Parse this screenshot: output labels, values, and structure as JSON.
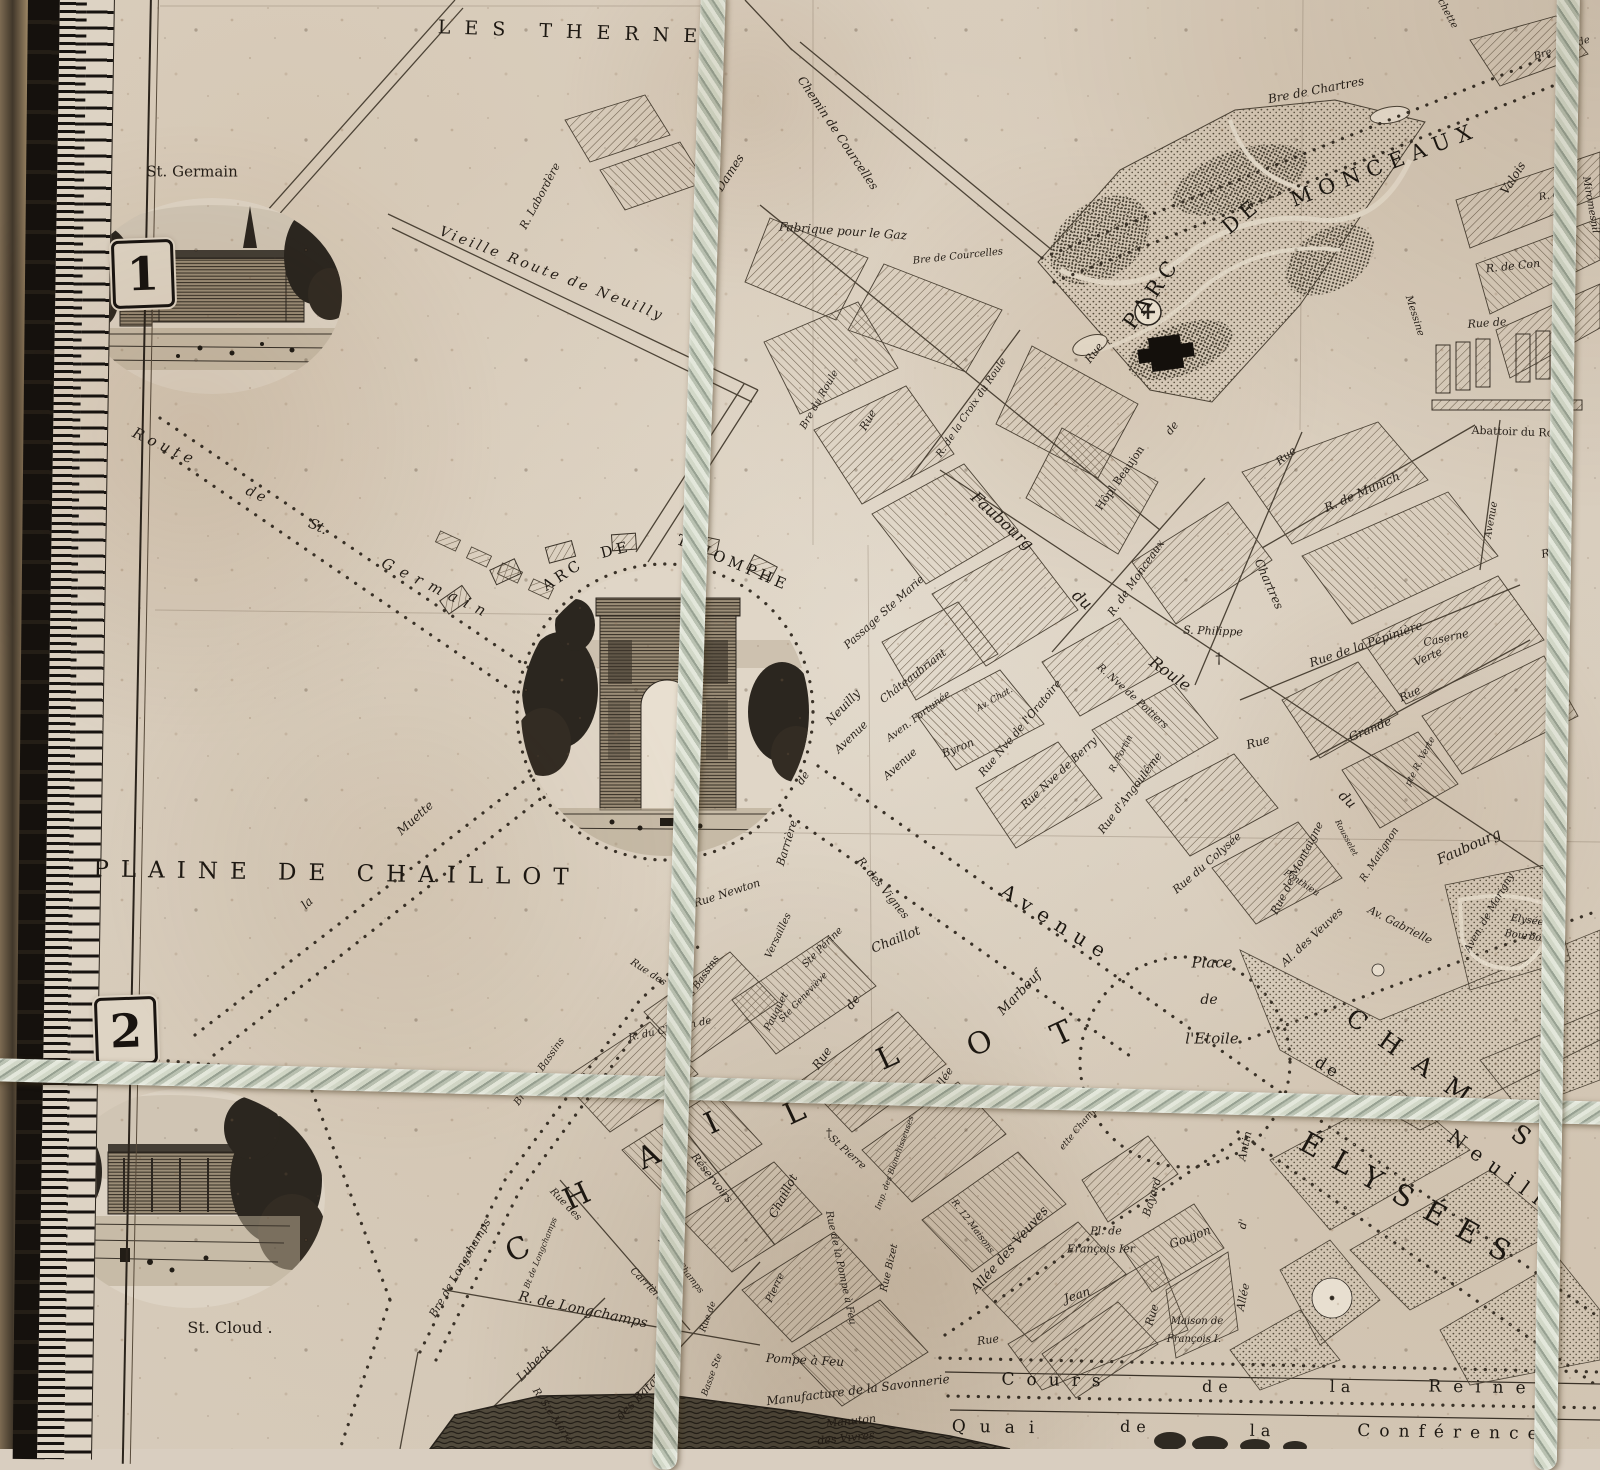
{
  "plates": {
    "n1": "1",
    "n2": "2"
  },
  "colors": {
    "paper": "#dcd2c3",
    "ink": "#27211a",
    "rope": "#b9c1b1",
    "hatch": "#6a5c4b"
  },
  "labels": [
    {
      "t": "LES THERNES",
      "x": 588,
      "y": 33,
      "r": 2,
      "s": 19,
      "ls": 14,
      "c": "cap"
    },
    {
      "t": "St. Germain",
      "x": 192,
      "y": 172,
      "r": 0,
      "s": 15,
      "c": "rm"
    },
    {
      "t": "Chemin de Courcelles",
      "x": 838,
      "y": 133,
      "r": 56,
      "s": 12
    },
    {
      "t": "des Dames",
      "x": 723,
      "y": 183,
      "r": -57,
      "s": 12
    },
    {
      "t": "R. Labordère",
      "x": 540,
      "y": 196,
      "r": -62,
      "s": 11
    },
    {
      "t": "Vieille Route de Neuilly",
      "x": 552,
      "y": 274,
      "r": 21,
      "s": 14,
      "ls": 3
    },
    {
      "t": "Fabrique pour le Gaz",
      "x": 843,
      "y": 231,
      "r": 4,
      "s": 12
    },
    {
      "t": "Bre de Courcelles",
      "x": 958,
      "y": 257,
      "r": -6,
      "s": 10
    },
    {
      "t": "Bre de Chartres",
      "x": 1316,
      "y": 90,
      "r": -11,
      "s": 12
    },
    {
      "t": "chette",
      "x": 1447,
      "y": 14,
      "r": 62,
      "s": 10
    },
    {
      "t": "Bre",
      "x": 1543,
      "y": 55,
      "r": -18,
      "s": 10
    },
    {
      "t": "de",
      "x": 1584,
      "y": 42,
      "r": -18,
      "s": 10
    },
    {
      "t": "PARC",
      "x": 1152,
      "y": 293,
      "r": -55,
      "s": 21,
      "ls": 6,
      "c": "cap"
    },
    {
      "t": "DE",
      "x": 1242,
      "y": 216,
      "r": -40,
      "s": 21,
      "ls": 6,
      "c": "cap"
    },
    {
      "t": "MONCEAUX",
      "x": 1385,
      "y": 165,
      "r": -21,
      "s": 21,
      "ls": 8,
      "c": "cap"
    },
    {
      "t": "Valois",
      "x": 1513,
      "y": 178,
      "r": -58,
      "s": 12
    },
    {
      "t": "R. de",
      "x": 1552,
      "y": 196,
      "r": -10,
      "s": 10
    },
    {
      "t": "R. de Con",
      "x": 1513,
      "y": 266,
      "r": -6,
      "s": 11
    },
    {
      "t": "Rue de",
      "x": 1487,
      "y": 323,
      "r": -4,
      "s": 11
    },
    {
      "t": "Messine",
      "x": 1414,
      "y": 316,
      "r": 72,
      "s": 10
    },
    {
      "t": "Miromesnil",
      "x": 1590,
      "y": 205,
      "r": 80,
      "s": 10
    },
    {
      "t": "Abattoir du Roule",
      "x": 1521,
      "y": 432,
      "r": 2,
      "s": 11,
      "c": "rm"
    },
    {
      "t": "Rue",
      "x": 1094,
      "y": 353,
      "r": -52,
      "s": 11
    },
    {
      "t": "de",
      "x": 1172,
      "y": 428,
      "r": -52,
      "s": 11
    },
    {
      "t": "Rue",
      "x": 1286,
      "y": 456,
      "r": -38,
      "s": 11
    },
    {
      "t": "Chartres",
      "x": 1269,
      "y": 584,
      "r": 66,
      "s": 12
    },
    {
      "t": "R. de Munich",
      "x": 1362,
      "y": 492,
      "r": -24,
      "s": 12
    },
    {
      "t": "Avenue",
      "x": 1492,
      "y": 520,
      "r": -80,
      "s": 10
    },
    {
      "t": "Rue",
      "x": 1552,
      "y": 552,
      "r": -14,
      "s": 11
    },
    {
      "t": "Hôpl Beaujon",
      "x": 1120,
      "y": 478,
      "r": -55,
      "s": 11,
      "c": "rm"
    },
    {
      "t": "R. de la Croix du Roule",
      "x": 972,
      "y": 408,
      "r": -56,
      "s": 10
    },
    {
      "t": "Bre du Roule",
      "x": 820,
      "y": 400,
      "r": -60,
      "s": 10
    },
    {
      "t": "Rue",
      "x": 868,
      "y": 420,
      "r": -60,
      "s": 11
    },
    {
      "t": "Faubourg",
      "x": 1002,
      "y": 521,
      "r": 42,
      "s": 16
    },
    {
      "t": "du",
      "x": 1082,
      "y": 600,
      "r": 42,
      "s": 16
    },
    {
      "t": "Roule",
      "x": 1170,
      "y": 674,
      "r": 36,
      "s": 16
    },
    {
      "t": "Passage Ste Marie",
      "x": 884,
      "y": 612,
      "r": -42,
      "s": 11
    },
    {
      "t": "S. Philippe",
      "x": 1213,
      "y": 631,
      "r": 2,
      "s": 11
    },
    {
      "t": "†",
      "x": 1219,
      "y": 659,
      "r": 0,
      "s": 15,
      "c": "rm"
    },
    {
      "t": "R. de Monceaux",
      "x": 1136,
      "y": 578,
      "r": -55,
      "s": 11
    },
    {
      "t": "Rue de la Pépinière",
      "x": 1366,
      "y": 644,
      "r": -19,
      "s": 12
    },
    {
      "t": "Caserne",
      "x": 1446,
      "y": 638,
      "r": -12,
      "s": 11
    },
    {
      "t": "Rue",
      "x": 1410,
      "y": 694,
      "r": -24,
      "s": 11
    },
    {
      "t": "Verte",
      "x": 1428,
      "y": 657,
      "r": -24,
      "s": 11
    },
    {
      "t": "Grande",
      "x": 1370,
      "y": 729,
      "r": -23,
      "s": 12
    },
    {
      "t": "Rue",
      "x": 1258,
      "y": 742,
      "r": -16,
      "s": 12
    },
    {
      "t": "pte R. Verte",
      "x": 1421,
      "y": 762,
      "r": -62,
      "s": 9
    },
    {
      "t": "du",
      "x": 1347,
      "y": 800,
      "r": 44,
      "s": 14
    },
    {
      "t": "Faubourg",
      "x": 1469,
      "y": 847,
      "r": -24,
      "s": 14
    },
    {
      "t": "Avenue",
      "x": 851,
      "y": 737,
      "r": -44,
      "s": 11
    },
    {
      "t": "Châteaubriant",
      "x": 913,
      "y": 676,
      "r": -38,
      "s": 11
    },
    {
      "t": "Aven. Fortunée",
      "x": 919,
      "y": 717,
      "r": -37,
      "s": 10
    },
    {
      "t": "Avenue",
      "x": 900,
      "y": 764,
      "r": -42,
      "s": 11
    },
    {
      "t": "Byron",
      "x": 958,
      "y": 748,
      "r": -22,
      "s": 11
    },
    {
      "t": "Av. Chat.",
      "x": 995,
      "y": 700,
      "r": -30,
      "s": 9
    },
    {
      "t": "Rue Nve de l'Oratoire",
      "x": 1020,
      "y": 728,
      "r": -50,
      "s": 11
    },
    {
      "t": "R. Nve de Poitiers",
      "x": 1132,
      "y": 697,
      "r": 42,
      "s": 10
    },
    {
      "t": "Rue Nve de Berry",
      "x": 1059,
      "y": 773,
      "r": -43,
      "s": 11
    },
    {
      "t": "R. Fortin",
      "x": 1122,
      "y": 754,
      "r": -62,
      "s": 9
    },
    {
      "t": "Rue d'Angoulême",
      "x": 1130,
      "y": 793,
      "r": -53,
      "s": 11
    },
    {
      "t": "Rue du Colysée",
      "x": 1207,
      "y": 863,
      "r": -41,
      "s": 11
    },
    {
      "t": "Rue de Montaigne",
      "x": 1297,
      "y": 868,
      "r": -63,
      "s": 11
    },
    {
      "t": "Ponthieu",
      "x": 1301,
      "y": 884,
      "r": 33,
      "s": 9
    },
    {
      "t": "Rousselet",
      "x": 1346,
      "y": 838,
      "r": 62,
      "s": 8
    },
    {
      "t": "R. Matignon",
      "x": 1380,
      "y": 855,
      "r": -57,
      "s": 10
    },
    {
      "t": "Al. des Veuves",
      "x": 1312,
      "y": 937,
      "r": -43,
      "s": 11
    },
    {
      "t": "Av. Gabrielle",
      "x": 1400,
      "y": 925,
      "r": 27,
      "s": 11
    },
    {
      "t": "Aven. de Marigny",
      "x": 1490,
      "y": 913,
      "r": -60,
      "s": 10
    },
    {
      "t": "Elysée",
      "x": 1527,
      "y": 921,
      "r": 8,
      "s": 10
    },
    {
      "t": "Bourbon",
      "x": 1526,
      "y": 937,
      "r": 8,
      "s": 10
    },
    {
      "t": "Place",
      "x": 1212,
      "y": 963,
      "r": 0,
      "s": 15
    },
    {
      "t": "de",
      "x": 1209,
      "y": 1000,
      "r": 0,
      "s": 14
    },
    {
      "t": "l'Etoile",
      "x": 1212,
      "y": 1039,
      "r": 0,
      "s": 15
    },
    {
      "t": "Avenue",
      "x": 1057,
      "y": 923,
      "r": 32,
      "s": 20,
      "ls": 9,
      "c": "cap"
    },
    {
      "t": "de",
      "x": 1328,
      "y": 1068,
      "r": 32,
      "s": 16,
      "ls": 4,
      "c": "cap"
    },
    {
      "t": "Neuilly",
      "x": 1508,
      "y": 1176,
      "r": 36,
      "s": 20,
      "ls": 10,
      "c": "cap"
    },
    {
      "t": "CHAMPS",
      "x": 1447,
      "y": 1083,
      "r": 35,
      "s": 25,
      "ls": 20,
      "c": "cap"
    },
    {
      "t": "ÉLYSÉES",
      "x": 1412,
      "y": 1201,
      "r": 29,
      "s": 29,
      "ls": 16,
      "c": "cap"
    },
    {
      "t": "C",
      "x": 518,
      "y": 1250,
      "r": -25,
      "s": 30,
      "c": "cap"
    },
    {
      "t": "H",
      "x": 577,
      "y": 1197,
      "r": -25,
      "s": 30,
      "c": "cap"
    },
    {
      "t": "A",
      "x": 649,
      "y": 1157,
      "r": -25,
      "s": 30,
      "c": "cap"
    },
    {
      "t": "I",
      "x": 712,
      "y": 1124,
      "r": -25,
      "s": 30,
      "c": "cap"
    },
    {
      "t": "L",
      "x": 795,
      "y": 1113,
      "r": -25,
      "s": 30,
      "c": "cap"
    },
    {
      "t": "L",
      "x": 888,
      "y": 1058,
      "r": -25,
      "s": 30,
      "c": "cap"
    },
    {
      "t": "O",
      "x": 980,
      "y": 1044,
      "r": -25,
      "s": 30,
      "c": "cap"
    },
    {
      "t": "T",
      "x": 1062,
      "y": 1034,
      "r": -25,
      "s": 30,
      "c": "cap"
    },
    {
      "t": "Barrière",
      "x": 787,
      "y": 843,
      "r": -73,
      "s": 11
    },
    {
      "t": "de",
      "x": 803,
      "y": 778,
      "r": -55,
      "s": 11
    },
    {
      "t": "Neuilly",
      "x": 843,
      "y": 707,
      "r": -46,
      "s": 12
    },
    {
      "t": "Rue Newton",
      "x": 727,
      "y": 893,
      "r": -18,
      "s": 11
    },
    {
      "t": "R. des Bassins",
      "x": 697,
      "y": 987,
      "r": -55,
      "s": 10
    },
    {
      "t": "Bre des Bassins",
      "x": 540,
      "y": 1072,
      "r": -55,
      "s": 10
    },
    {
      "t": "R. du Chemin de",
      "x": 670,
      "y": 1030,
      "r": -12,
      "s": 10
    },
    {
      "t": "Versailles",
      "x": 779,
      "y": 936,
      "r": -65,
      "s": 10
    },
    {
      "t": "Pauquet",
      "x": 777,
      "y": 1012,
      "r": -63,
      "s": 10
    },
    {
      "t": "Ste Périne",
      "x": 823,
      "y": 948,
      "r": -45,
      "s": 10
    },
    {
      "t": "Ste Geneviève",
      "x": 804,
      "y": 998,
      "r": -46,
      "s": 9
    },
    {
      "t": "R. des Vignes",
      "x": 883,
      "y": 888,
      "r": 51,
      "s": 11
    },
    {
      "t": "Rue",
      "x": 822,
      "y": 1058,
      "r": -55,
      "s": 12
    },
    {
      "t": "de",
      "x": 853,
      "y": 1002,
      "r": -50,
      "s": 12
    },
    {
      "t": "Chaillot",
      "x": 896,
      "y": 940,
      "r": -22,
      "s": 13
    },
    {
      "t": "Marbeuf",
      "x": 1020,
      "y": 993,
      "r": -46,
      "s": 13
    },
    {
      "t": "Allée",
      "x": 943,
      "y": 1080,
      "r": -57,
      "s": 11
    },
    {
      "t": "Rue des",
      "x": 648,
      "y": 973,
      "r": 33,
      "s": 10
    },
    {
      "t": "Réservoirs",
      "x": 712,
      "y": 1178,
      "r": 52,
      "s": 11
    },
    {
      "t": "Rue des",
      "x": 565,
      "y": 1205,
      "r": 46,
      "s": 10
    },
    {
      "t": "Carrières",
      "x": 648,
      "y": 1287,
      "r": 46,
      "s": 10
    },
    {
      "t": "R. des Champs",
      "x": 680,
      "y": 1266,
      "r": 52,
      "s": 9
    },
    {
      "t": "Bre de Longchamps",
      "x": 460,
      "y": 1268,
      "r": -60,
      "s": 11
    },
    {
      "t": "Bt de Longchamps",
      "x": 541,
      "y": 1253,
      "r": -68,
      "s": 8
    },
    {
      "t": "R. de Longchamps",
      "x": 583,
      "y": 1310,
      "r": 12,
      "s": 14
    },
    {
      "t": "Lubeck",
      "x": 534,
      "y": 1363,
      "r": -46,
      "s": 12
    },
    {
      "t": "R. Ste Marie",
      "x": 552,
      "y": 1416,
      "r": 56,
      "s": 10
    },
    {
      "t": "des Batailles",
      "x": 645,
      "y": 1390,
      "r": -46,
      "s": 12
    },
    {
      "t": "Rue de",
      "x": 709,
      "y": 1317,
      "r": -70,
      "s": 9
    },
    {
      "t": "Basse Ste",
      "x": 713,
      "y": 1375,
      "r": -70,
      "s": 9
    },
    {
      "t": "Chaillot",
      "x": 783,
      "y": 1196,
      "r": -62,
      "s": 12
    },
    {
      "t": "Rue de la Pompe à Feu",
      "x": 840,
      "y": 1268,
      "r": 78,
      "s": 10
    },
    {
      "t": "St Pierre",
      "x": 847,
      "y": 1153,
      "r": 42,
      "s": 10
    },
    {
      "t": "†",
      "x": 829,
      "y": 1133,
      "r": 0,
      "s": 12,
      "c": "rm"
    },
    {
      "t": "Pierre",
      "x": 776,
      "y": 1288,
      "r": -65,
      "s": 10
    },
    {
      "t": "Imp. des Blanchisseuses",
      "x": 895,
      "y": 1163,
      "r": -70,
      "s": 8
    },
    {
      "t": "Rue Bizet",
      "x": 890,
      "y": 1268,
      "r": -77,
      "s": 10
    },
    {
      "t": "R. 12 Maisons",
      "x": 972,
      "y": 1227,
      "r": 53,
      "s": 9
    },
    {
      "t": "Allée des Veuves",
      "x": 1010,
      "y": 1250,
      "r": -49,
      "s": 13
    },
    {
      "t": "ette Champ.",
      "x": 1080,
      "y": 1128,
      "r": -50,
      "s": 9
    },
    {
      "t": "Pl. de",
      "x": 1106,
      "y": 1231,
      "r": 0,
      "s": 11
    },
    {
      "t": "François Ier",
      "x": 1101,
      "y": 1249,
      "r": 0,
      "s": 11
    },
    {
      "t": "Rue",
      "x": 988,
      "y": 1340,
      "r": -8,
      "s": 11
    },
    {
      "t": "Jean",
      "x": 1077,
      "y": 1295,
      "r": -18,
      "s": 12
    },
    {
      "t": "Goujon",
      "x": 1190,
      "y": 1237,
      "r": -21,
      "s": 12
    },
    {
      "t": "Rue",
      "x": 1152,
      "y": 1315,
      "r": -73,
      "s": 11
    },
    {
      "t": "Bayard",
      "x": 1152,
      "y": 1197,
      "r": -73,
      "s": 11
    },
    {
      "t": "Maison de",
      "x": 1197,
      "y": 1322,
      "r": 0,
      "s": 10
    },
    {
      "t": "François I.",
      "x": 1194,
      "y": 1340,
      "r": 0,
      "s": 10
    },
    {
      "t": "Allée",
      "x": 1243,
      "y": 1297,
      "r": -78,
      "s": 11
    },
    {
      "t": "d'",
      "x": 1243,
      "y": 1224,
      "r": -78,
      "s": 11
    },
    {
      "t": "Antin",
      "x": 1245,
      "y": 1146,
      "r": -78,
      "s": 11
    },
    {
      "t": "Pompe à Feu",
      "x": 805,
      "y": 1360,
      "r": 3,
      "s": 12
    },
    {
      "t": "Manufacture de la Savonnerie",
      "x": 858,
      "y": 1390,
      "r": -7,
      "s": 12
    },
    {
      "t": "Manuton",
      "x": 851,
      "y": 1421,
      "r": -6,
      "s": 11
    },
    {
      "t": "des Vivres",
      "x": 846,
      "y": 1438,
      "r": -6,
      "s": 11
    },
    {
      "t": "Cours",
      "x": 1057,
      "y": 1381,
      "r": 1,
      "s": 17,
      "ls": 12,
      "c": "cap"
    },
    {
      "t": "de",
      "x": 1218,
      "y": 1387,
      "r": 1,
      "s": 16,
      "ls": 6,
      "c": "cap"
    },
    {
      "t": "la",
      "x": 1343,
      "y": 1387,
      "r": 1,
      "s": 16,
      "ls": 6,
      "c": "cap"
    },
    {
      "t": "Reine",
      "x": 1483,
      "y": 1388,
      "r": 1,
      "s": 17,
      "ls": 12,
      "c": "cap"
    },
    {
      "t": "Quai",
      "x": 1000,
      "y": 1428,
      "r": 1,
      "s": 17,
      "ls": 14,
      "c": "cap"
    },
    {
      "t": "de",
      "x": 1136,
      "y": 1427,
      "r": 1,
      "s": 16,
      "ls": 6,
      "c": "cap"
    },
    {
      "t": "la",
      "x": 1263,
      "y": 1431,
      "r": 1,
      "s": 16,
      "ls": 6,
      "c": "cap"
    },
    {
      "t": "Conférence",
      "x": 1452,
      "y": 1433,
      "r": 1,
      "s": 17,
      "ls": 9,
      "c": "cap"
    },
    {
      "t": "St. Cloud .",
      "x": 230,
      "y": 1328,
      "r": 0,
      "s": 16,
      "c": "rm"
    },
    {
      "t": "Route",
      "x": 165,
      "y": 447,
      "r": 25,
      "s": 15,
      "ls": 5
    },
    {
      "t": "de",
      "x": 257,
      "y": 495,
      "r": 25,
      "s": 14,
      "ls": 3
    },
    {
      "t": "St.",
      "x": 318,
      "y": 527,
      "r": 25,
      "s": 14
    },
    {
      "t": "Germain",
      "x": 437,
      "y": 589,
      "r": 26,
      "s": 15,
      "ls": 8
    },
    {
      "t": "PLAINE DE CHAILLOT",
      "x": 337,
      "y": 874,
      "r": 1,
      "s": 23,
      "ls": 12,
      "c": "cap"
    },
    {
      "t": "la",
      "x": 307,
      "y": 903,
      "r": -43,
      "s": 12
    },
    {
      "t": "Muette",
      "x": 415,
      "y": 818,
      "r": -42,
      "s": 12
    },
    {
      "t": "Route",
      "x": 140,
      "y": 1045,
      "r": -33,
      "s": 11
    },
    {
      "t": "ARC",
      "x": 563,
      "y": 575,
      "r": -33,
      "s": 15,
      "ls": 4,
      "c": "cap"
    },
    {
      "t": "DE",
      "x": 616,
      "y": 550,
      "r": -14,
      "s": 15,
      "ls": 4,
      "c": "cap"
    },
    {
      "t": "TRIOMPHE",
      "x": 733,
      "y": 563,
      "r": 23,
      "s": 15,
      "ls": 4,
      "c": "cap"
    }
  ]
}
